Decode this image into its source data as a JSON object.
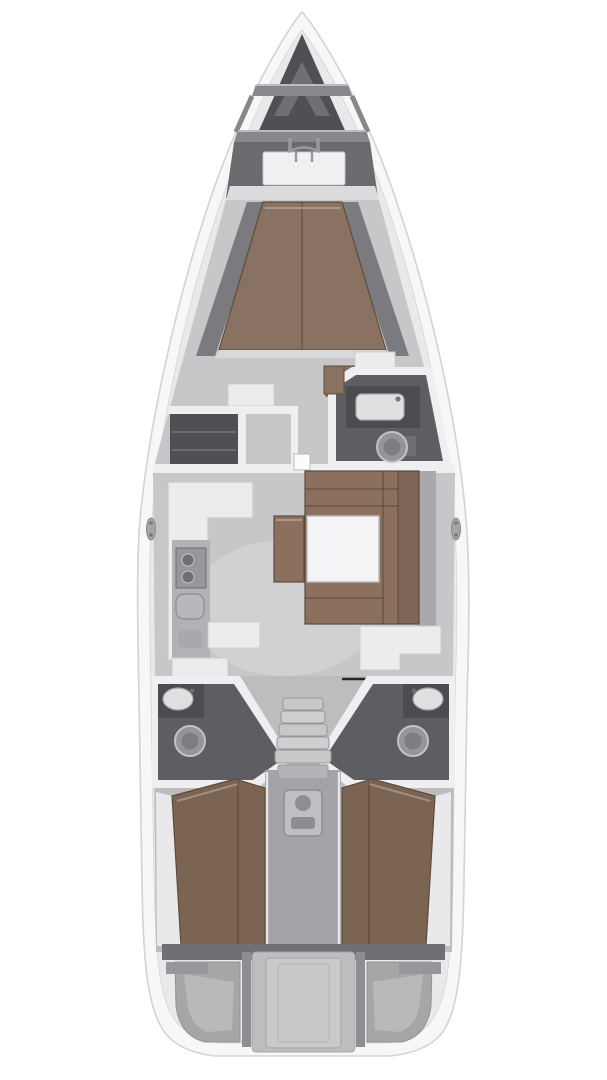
{
  "meta": {
    "title": "Sailing yacht interior layout plan, top-down view",
    "diagram_type": "boat-floor-plan",
    "text_content": "none (image contains no rendered text)"
  },
  "colors": {
    "page-bg": "#ffffff",
    "hull": "#f7f7f8",
    "hull-stroke": "#d3d3d6",
    "deck": "#e9e9eb",
    "wall": "#efeff1",
    "floor": "#c7c7ca",
    "floor-aft": "#bdbdc0",
    "floor-sheen": "#d8d8da",
    "locker": "#4f4f54",
    "bow-chevron": "#6f6f74",
    "beam": "#87878c",
    "deck-wedge": "#6a6a6f",
    "windlass": "#f1f1f3",
    "berth-fwd": "#8a7263",
    "sofa": "#8b705e",
    "berth-aft": "#7c6453",
    "brown-edge": "#5e4b3c",
    "furniture": "#ececee",
    "furniture-stroke": "#cbcbce",
    "worktop": "#b2b2b5",
    "appliance": "#97979b",
    "appliance-dark": "#6f6f73",
    "head-floor": "#5d5d62",
    "counter-dark": "#4b4b50",
    "basin": "#e0e0e2",
    "toilet": "#95959a",
    "toilet-stroke": "#c3c3c6",
    "stairs": "#c8c8cb",
    "stairs-stroke": "#97979b",
    "corridor": "#a4a4a8",
    "engine": "#bfbfc3",
    "engine-dark": "#8e8e92",
    "stern-band": "#707074",
    "stern-mid": "#a6a6a9",
    "stern-frame": "#bdbdc0",
    "stern-light": "#c9c9cc",
    "shelf": "#a9a9ad",
    "shelf-dark": "#7a7a7f",
    "headboard": "#dcdcde",
    "table": "#f4f4f6",
    "nav-edge": "#27272a",
    "cleat": "#a5a5a8"
  },
  "regions": [
    {
      "name": "anchor-locker",
      "label": "bow anchor locker"
    },
    {
      "name": "windlass",
      "label": "anchor windlass / bow roller"
    },
    {
      "name": "forward-cabin",
      "label": "forward owner cabin with V-berth"
    },
    {
      "name": "forward-head",
      "label": "forward bathroom with sink and toilet"
    },
    {
      "name": "port-wardrobe",
      "label": "port wardrobe / locker"
    },
    {
      "name": "galley",
      "label": "port galley with stove and sink"
    },
    {
      "name": "salon-dinette",
      "label": "starboard U-shaped dinette with table"
    },
    {
      "name": "nav-station",
      "label": "starboard chart / nav desk"
    },
    {
      "name": "aft-head-port",
      "label": "port aft bathroom with sink and toilet"
    },
    {
      "name": "aft-head-starboard",
      "label": "starboard aft bathroom with sink and toilet"
    },
    {
      "name": "companionway",
      "label": "companionway stairs"
    },
    {
      "name": "engine-compartment",
      "label": "engine compartment under stairs"
    },
    {
      "name": "aft-cabin-port",
      "label": "port aft cabin with double berth"
    },
    {
      "name": "aft-cabin-starboard",
      "label": "starboard aft cabin with double berth"
    },
    {
      "name": "transom",
      "label": "stern transom with lockers and swim platform panel"
    }
  ]
}
